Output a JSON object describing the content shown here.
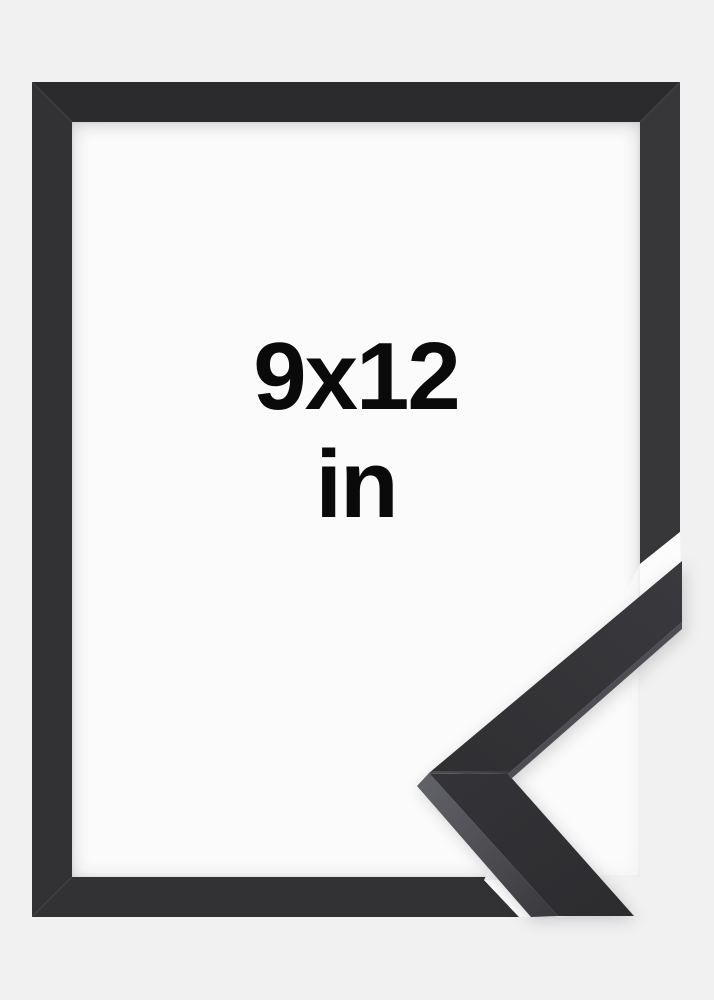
{
  "product": {
    "size_label": "9x12",
    "unit_label": "in"
  },
  "colors": {
    "background": "#f1f1f2",
    "frame_black": "#2e2e30",
    "opening_white": "#fbfbfc",
    "moulding_side_gray": "#54545a",
    "label_text": "#0a0a0a"
  }
}
